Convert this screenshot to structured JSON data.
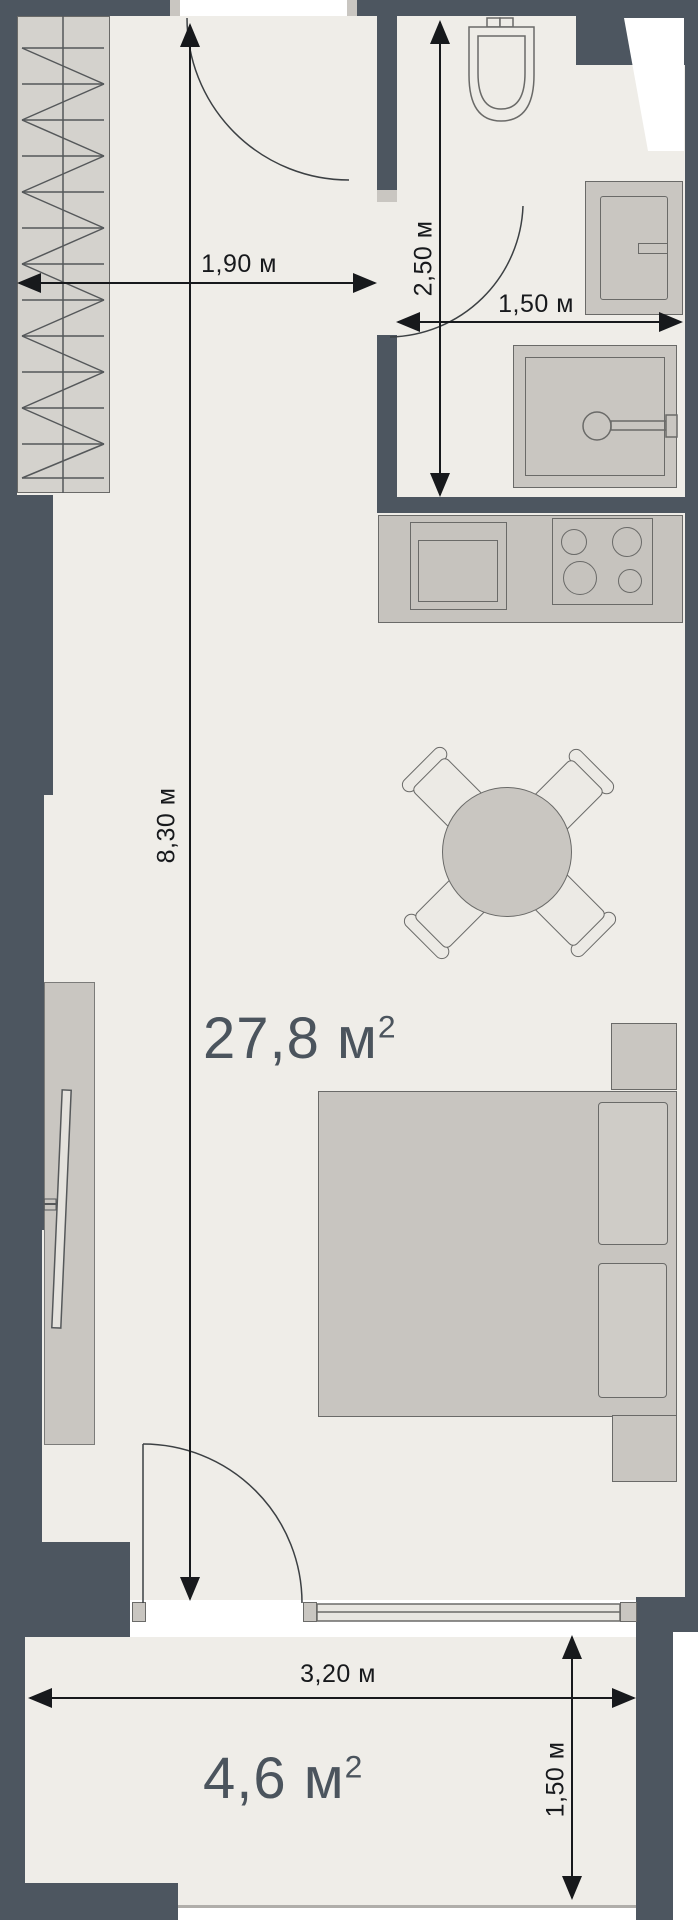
{
  "title": "apartment-floor-plan",
  "areas": {
    "main_room": {
      "text": "27,8 м",
      "sup": "2"
    },
    "balcony": {
      "text": "4,6 м",
      "sup": "2"
    }
  },
  "dimensions": {
    "hallway_width": "1,90 м",
    "bathroom_length": "2,50 м",
    "bathroom_width": "1,50 м",
    "room_length": "8,30 м",
    "balcony_width": "3,20 м",
    "balcony_depth": "1,50 м"
  },
  "colors": {
    "wall": "#4d5660",
    "floor": "#efede8",
    "furniture": "#c9c6c1",
    "dimension_text": "#17191c",
    "area_text": "#4b545d"
  }
}
